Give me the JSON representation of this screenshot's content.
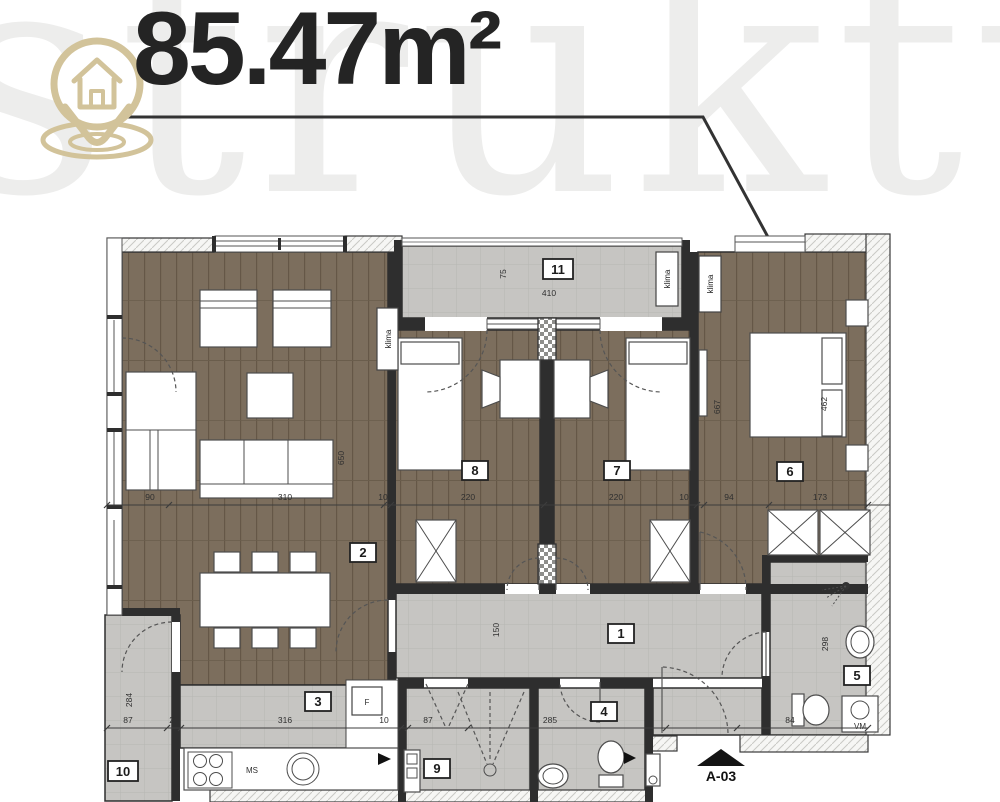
{
  "title": {
    "area": "85.47m²"
  },
  "watermark": {
    "text": "struktura"
  },
  "rooms": {
    "n1": "1",
    "n2": "2",
    "n3": "3",
    "n4": "4",
    "n5": "5",
    "n6": "6",
    "n7": "7",
    "n8": "8",
    "n9": "9",
    "n10": "10",
    "n11": "11"
  },
  "labels": {
    "klima": "klima",
    "fridge": "F",
    "stove": "MS",
    "washer": "VM",
    "section_marker": "A-03"
  },
  "dims": {
    "top": [
      "90",
      "310",
      "10",
      "220",
      "220",
      "10",
      "94",
      "173"
    ],
    "bottom": [
      "87",
      "20",
      "316",
      "10",
      "87",
      "285",
      "84"
    ],
    "vertical": [
      "650",
      "150",
      "667",
      "462",
      "298",
      "284",
      "75"
    ],
    "balcony": "410"
  },
  "colors": {
    "logo_tan": "#d2c39a",
    "wood_floor": "#7c6e5d",
    "tile_gray": "#c6c5c2",
    "wall_dark": "#2e2e2e",
    "title_text": "#242424"
  }
}
